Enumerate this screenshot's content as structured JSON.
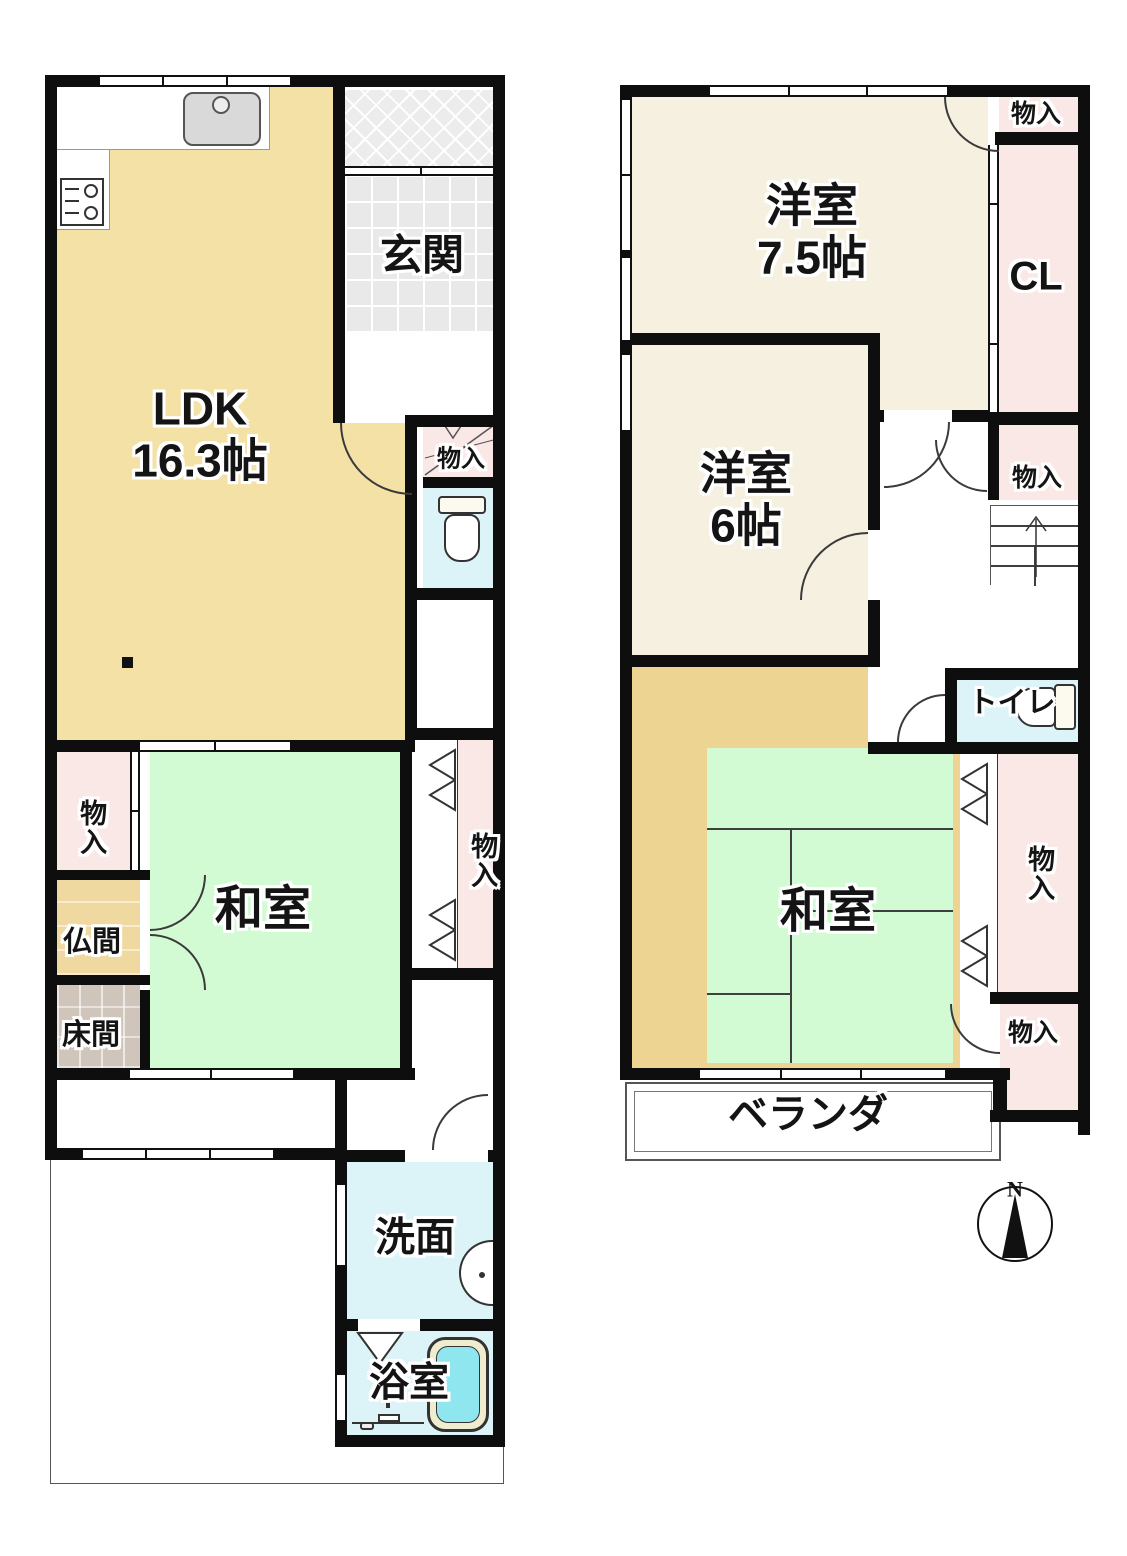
{
  "floor1": {
    "ldk": {
      "name": "LDK",
      "size": "16.3帖"
    },
    "genkan": {
      "name": "玄関"
    },
    "closet_understairs": {
      "name": "物入"
    },
    "closet_west": {
      "name": "物入"
    },
    "butsuma": {
      "name": "仏間"
    },
    "tokonoma": {
      "name": "床間"
    },
    "washitsu": {
      "name": "和室"
    },
    "closet_hall": {
      "name": "物入"
    },
    "senmen": {
      "name": "洗面"
    },
    "bathroom": {
      "name": "浴室"
    }
  },
  "floor2": {
    "western_room_75": {
      "name": "洋室",
      "size": "7.5帖"
    },
    "closet_top": {
      "name": "物入"
    },
    "closet_cl": {
      "name": "CL"
    },
    "western_room_6": {
      "name": "洋室",
      "size": "6帖"
    },
    "closet_stairs": {
      "name": "物入"
    },
    "toilet": {
      "name": "トイレ"
    },
    "washitsu": {
      "name": "和室"
    },
    "closet_east": {
      "name": "物入"
    },
    "closet_southeast": {
      "name": "物入"
    },
    "veranda": {
      "name": "ベランダ"
    }
  },
  "compass": {
    "north": "N"
  },
  "colors": {
    "wall": "#0E0E0E",
    "ldk_tan": "#F4E1A6",
    "tatami_green": "#D2FBD4",
    "closet_pink": "#FAE8E7",
    "water_cyan": "#DCF3F8",
    "western_cream": "#F6F0E0",
    "entry_tile_gray": "#E9E9E9",
    "tokonoma_gray": "#CFC5BB",
    "butsuma_tan": "#EFD9A0",
    "tatami_edge_tan": "#EDD492",
    "bath_water": "#8FE6EF"
  }
}
